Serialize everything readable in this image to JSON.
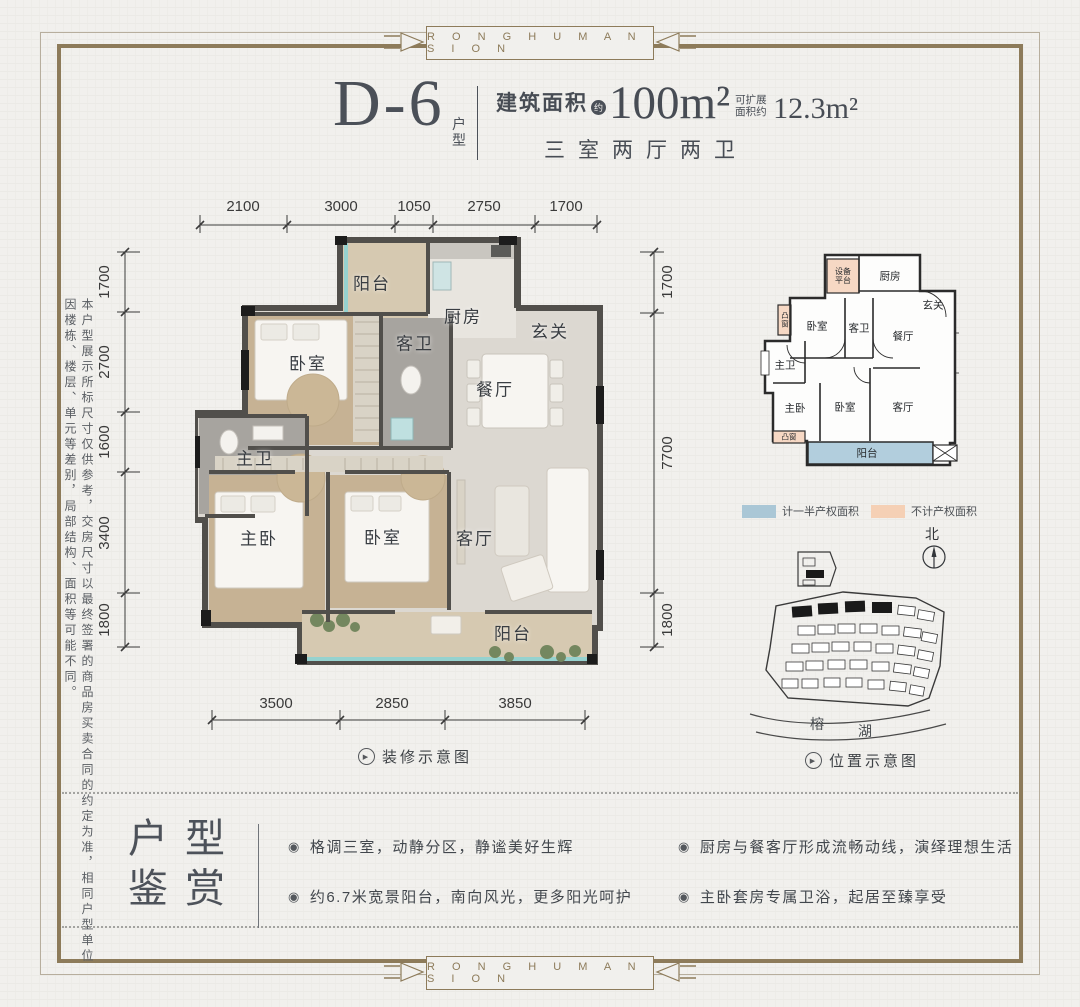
{
  "brand": {
    "text": "R O N G H U M A N S I O N"
  },
  "header": {
    "unit_code": "D-6",
    "unit_suffix": "户型",
    "area_label": "建筑面积",
    "area_note": "约",
    "area_value": "100m²",
    "expand_note": "可扩展面积约",
    "expand_value": "12.3m²",
    "rooms_summary": "三室两厅两卫"
  },
  "disclaimer": "本户型展示所标尺寸仅供参考，交房尺寸以最终签署的商品房买卖合同的约定为准，相同户型单位因楼栋、楼层、单元等差别，局部结构、面积等可能不同。",
  "floorplan": {
    "dims_top": [
      "2100",
      "3000",
      "1050",
      "2750",
      "1700"
    ],
    "dims_left": [
      "1700",
      "2700",
      "1600",
      "3400",
      "1800"
    ],
    "dims_right": [
      "1700",
      "7700",
      "1800"
    ],
    "dims_bottom": [
      "3500",
      "2850",
      "3850"
    ],
    "rooms": {
      "balcony_top": "阳台",
      "kitchen": "厨房",
      "foyer": "玄关",
      "bedroom_top": "卧室",
      "guest_bath": "客卫",
      "dining": "餐厅",
      "master_bath": "主卫",
      "master_bedroom": "主卧",
      "bedroom_second": "卧室",
      "living_room": "客厅",
      "balcony_bottom": "阳台"
    },
    "caption": "装修示意图"
  },
  "schematic": {
    "rooms": {
      "equipment_platform": "设备平台",
      "kitchen": "厨房",
      "foyer": "玄关",
      "bay_window_top": "凸窗",
      "bedroom_top": "卧室",
      "guest_bath": "客卫",
      "dining": "餐厅",
      "master_bath": "主卫",
      "master_bedroom": "主卧",
      "bedroom_second": "卧室",
      "living_room": "客厅",
      "bay_window_bottom": "凸窗",
      "balcony": "阳台"
    },
    "legend": [
      {
        "label": "计一半产权面积",
        "color": "#aac7d6"
      },
      {
        "label": "不计产权面积",
        "color": "#f5d0b5"
      }
    ],
    "north_label": "北"
  },
  "siteplan": {
    "lake_char_1": "榕",
    "lake_char_2": "湖",
    "caption": "位置示意图"
  },
  "appreciation": {
    "title_line_1": "户型",
    "title_line_2": "鉴赏",
    "bullets": [
      "格调三室，动静分区，静谧美好生辉",
      "约6.7米宽景阳台，南向风光，更多阳光呵护",
      "厨房与餐客厅形成流畅动线，演绎理想生活",
      "主卧套房专属卫浴，起居至臻享受"
    ]
  }
}
